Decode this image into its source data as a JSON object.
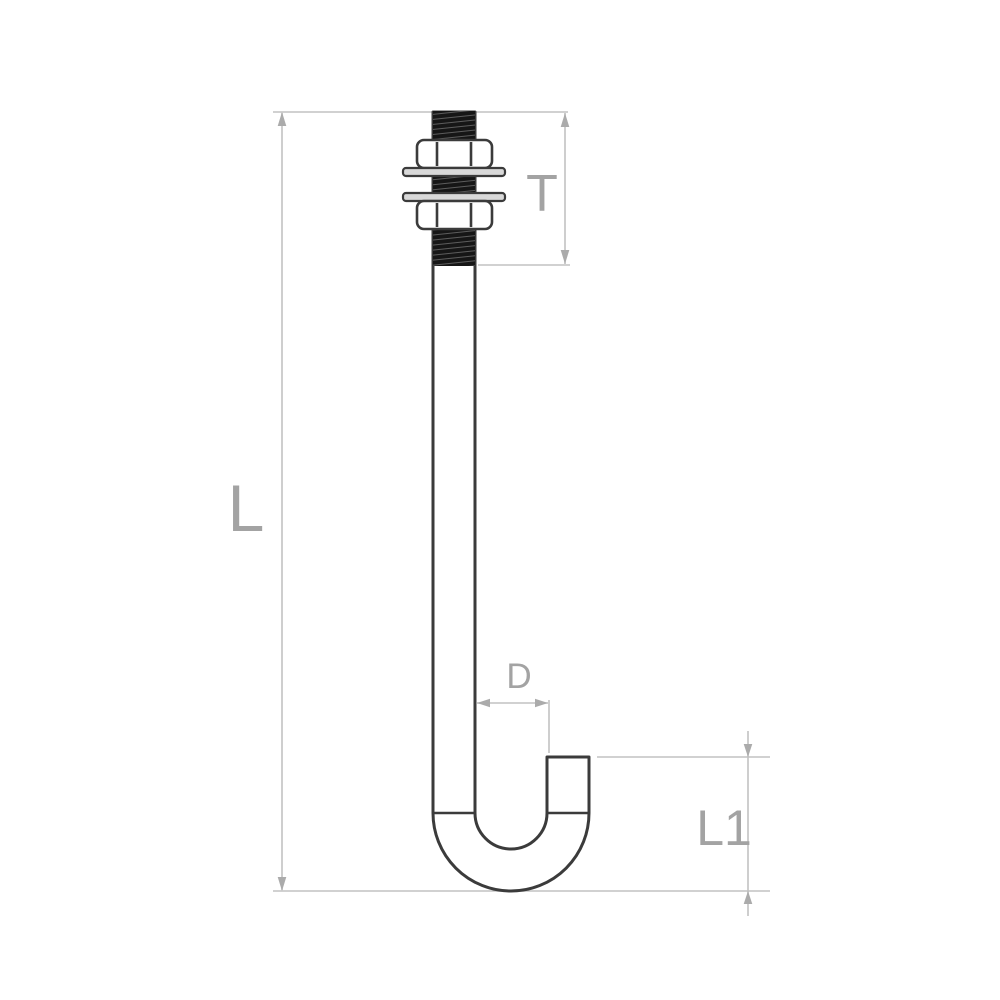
{
  "diagram": {
    "dimension_labels": {
      "overall_length": "L",
      "thread_length": "T",
      "diameter": "D",
      "hook_height": "L1"
    },
    "colors": {
      "background": "#ffffff",
      "outline": "#3b3b3b",
      "thread-fill": "#161616",
      "washer-fill": "#d9d9d9",
      "dimension-line": "#c2c2c2",
      "arrow": "#ababab",
      "label-text": "#a3a3a3"
    }
  }
}
